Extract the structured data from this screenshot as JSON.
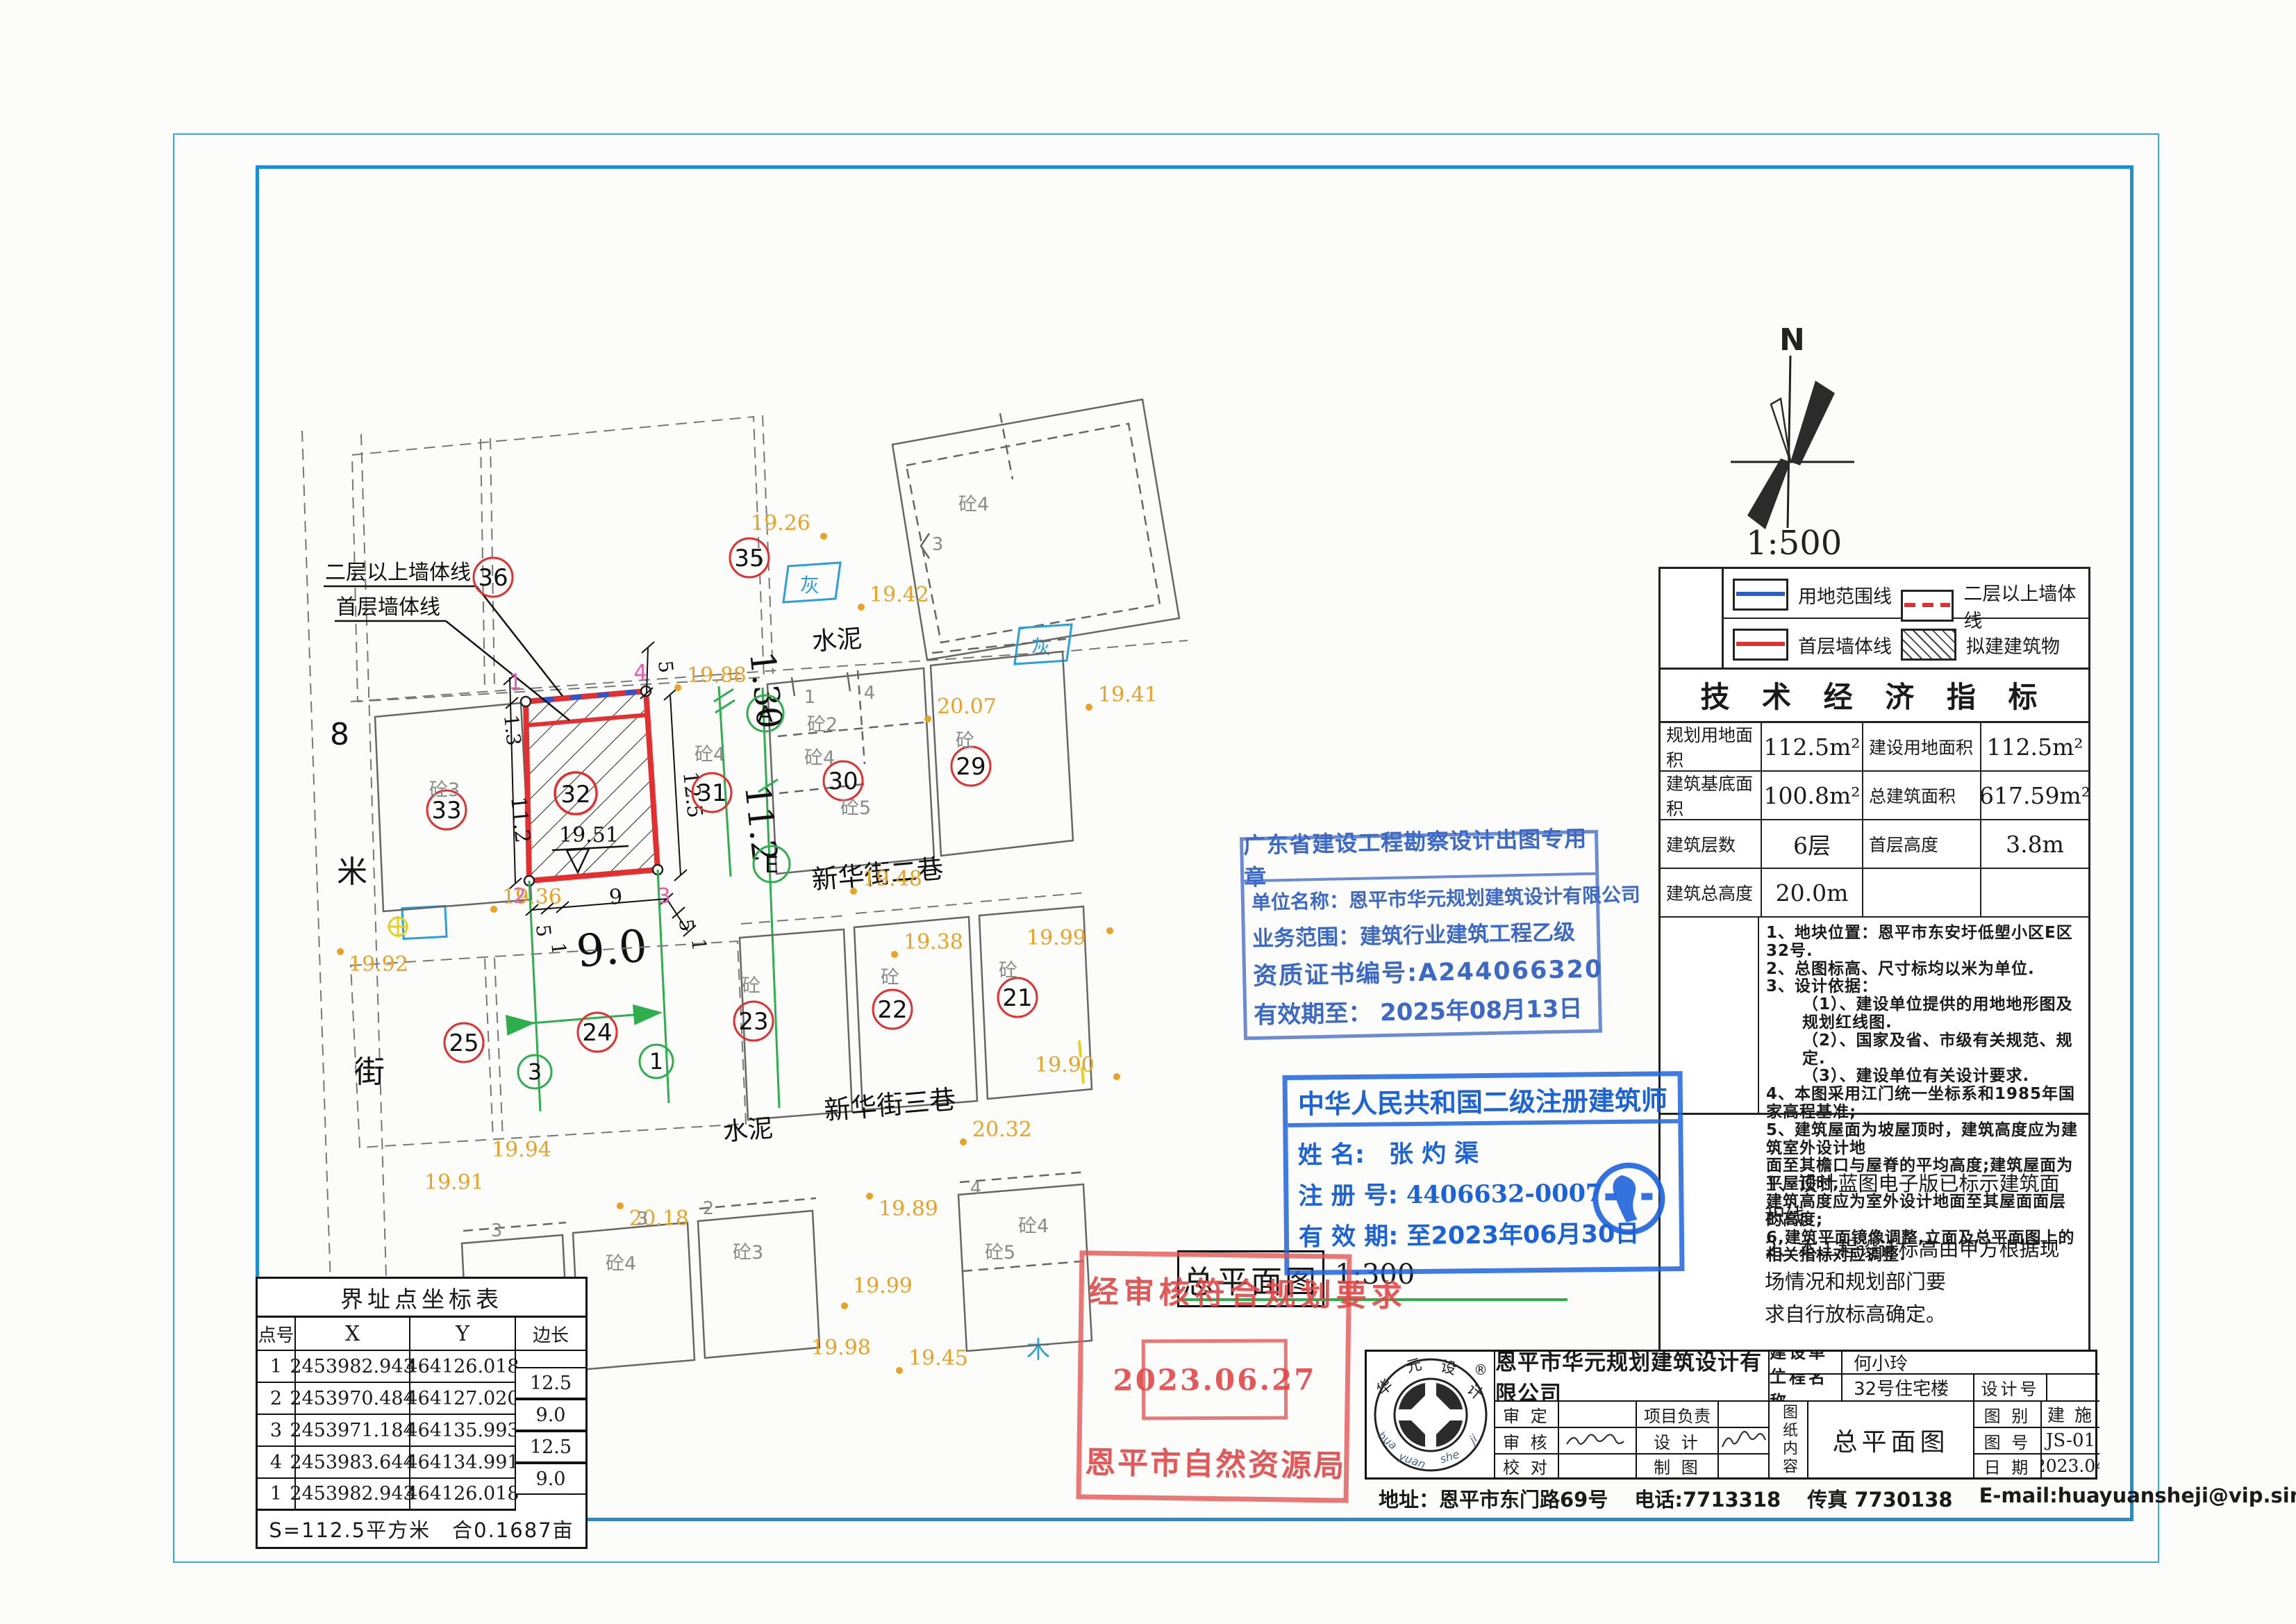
{
  "page": {
    "plan_title": "总平面图",
    "scale_plan": "1:300",
    "scale_main": "1:500",
    "north_label": "N"
  },
  "legend": {
    "items": [
      "用地范围线",
      "二层以上墙体线",
      "首层墙体线",
      "拟建建筑物"
    ]
  },
  "indicators": {
    "title": "技 术 经 济 指 标",
    "r1k1": "规划用地面积",
    "r1v1": "112.5m²",
    "r1k2": "建设用地面积",
    "r1v2": "112.5m²",
    "r2k1": "建筑基底面积",
    "r2v1": "100.8m²",
    "r2k2": "总建筑面积",
    "r2v2": "617.59m²",
    "r3k1": "建筑层数",
    "r3v1": "6层",
    "r3k2": "首层高度",
    "r3v2": "3.8m",
    "r4k1": "建筑总高度",
    "r4v1": "20.0m"
  },
  "notes": {
    "lines": [
      "1、地块位置：恩平市东安圩低塱小区E区32号.",
      "2、总图标高、尺寸标均以米为单位.",
      "3、设计依据：",
      "（1）、建设单位提供的用地地形图及规划红线图.",
      "（2）、国家及省、市级有关规范、规定.",
      "（3）、建设单位有关设计要求.",
      "4、本图采用江门统一坐标系和1985年国家高程基准;",
      "5、建筑屋面为坡屋顶时，建筑高度应为建筑室外设计地",
      "面至其檐口与屋脊的平均高度;建筑屋面为平屋顶时,",
      "建筑高度应为室外设计地面至其屋面面层的高度;",
      "6,建筑平面镜像调整,立面及总平面图上的相关指标对应调整."
    ]
  },
  "notes2": {
    "lines": [
      "1、设计蓝图电子版已标示建筑面积线。",
      "2、本工程设计标高由甲方根据现场情况和规划部门要",
      "求自行放标高确定。"
    ]
  },
  "stamp_blue1": {
    "title": "广东省建设工程勘察设计出图专用章",
    "l1": "单位名称：恩平市华元规划建筑设计有限公司",
    "l2": "业务范围：建筑行业建筑工程乙级",
    "l3": "资质证书编号:A244066320",
    "l4": "有效期至：  2025年08月13日"
  },
  "stamp_blue2": {
    "title": "中华人民共和国二级注册建筑师",
    "name_label": "姓  名:",
    "name": "张 灼 渠",
    "reg_label": "注 册 号:",
    "reg": "4406632-0007",
    "valid_label": "有 效 期:",
    "valid": "至2023年06月30日"
  },
  "stamp_red": {
    "line1": "经审核符合规划要求",
    "date": "2023.06.27",
    "org": "恩平市自然资源局"
  },
  "coord_table": {
    "title": "界址点坐标表",
    "headers": [
      "点号",
      "X",
      "Y",
      "边长"
    ],
    "rows": [
      [
        "1",
        "2453982.943",
        "464126.018"
      ],
      [
        "2",
        "2453970.484",
        "464127.020"
      ],
      [
        "3",
        "2453971.184",
        "464135.993"
      ],
      [
        "4",
        "2453983.644",
        "464134.991"
      ],
      [
        "1",
        "2453982.943",
        "464126.018"
      ]
    ],
    "edges": [
      "12.5",
      "9.0",
      "12.5",
      "9.0"
    ],
    "footer": "S=112.5平方米　合0.1687亩"
  },
  "titleblock": {
    "company": "恩平市华元规划建筑设计有限公司",
    "client_label": "建设单位",
    "client": "何小玲",
    "project_label": "工程名称",
    "project": "32号住宅楼",
    "design_no_label": "设计号",
    "shending": "审  定",
    "xiangmu": "项目负责",
    "shenhe": "审  核",
    "sheji": "设  计",
    "jiaodui": "校  对",
    "zhitu": "制  图",
    "content_label": "图纸内容",
    "content": "总平面图",
    "tubie_label": "图  别",
    "tubie": "建 施",
    "tuhao_label": "图  号",
    "tuhao": "JS-01",
    "riqi_label": "日  期",
    "riqi": "2023.04",
    "address": "地址：恩平市东门路69号",
    "phone": "电话:7713318",
    "fax": "传真 7730138",
    "email": "E-mail:huayuansheji@vip.sina.com",
    "logo_chars": [
      "华",
      "元",
      "设",
      "计"
    ],
    "logo_reg": "®",
    "logo_pinyin": [
      "hua",
      "yuan",
      "she",
      "ji"
    ]
  },
  "plan": {
    "leader_upper": "二层以上墙体线",
    "leader_lower": "首层墙体线",
    "street_cement_top": "水泥",
    "street_cement_bottom": "水泥",
    "street_lane2": "新华街二巷",
    "street_lane3": "新华街三巷",
    "street8_chars": [
      "8",
      "米",
      "街"
    ],
    "red_circles": [
      "36",
      "35",
      "33",
      "32",
      "31",
      "30",
      "29",
      "25",
      "24",
      "23",
      "22",
      "21"
    ],
    "green_circles": [
      "3",
      "1",
      "A",
      "E"
    ],
    "corners": [
      "1",
      "4",
      "2",
      "3"
    ],
    "elevations": [
      "19.26",
      "19.42",
      "19.41",
      "19.88",
      "20.07",
      "19.92",
      "19.36",
      "19.48",
      "19.38",
      "19.99",
      "19.90",
      "19.94",
      "19.91",
      "20.18",
      "19.89",
      "20.32",
      "19.99",
      "19.98",
      "19.45"
    ],
    "spot_level": "19.51",
    "materials": [
      "砼4",
      "砼2",
      "砼4",
      "砼4",
      "砼5",
      "砼",
      "砼3",
      "砼",
      "砼",
      "砼",
      "砼4",
      "砼3",
      "砼5",
      "砼5",
      "砼4"
    ],
    "edge_numbers": [
      "1",
      "4",
      "3",
      "3",
      "3",
      "2",
      "4"
    ],
    "dims": {
      "d13": "1.3",
      "d112": "11.2",
      "d125": "12.5",
      "d5a": "5",
      "d5b": "5",
      "d1b": "1",
      "d9": "9",
      "d90": "9.0",
      "d5c": "5",
      "d1c": "1",
      "big130": "1.30",
      "big112": "11.2"
    },
    "gray_marker": "灰",
    "tree_marker": "木"
  }
}
